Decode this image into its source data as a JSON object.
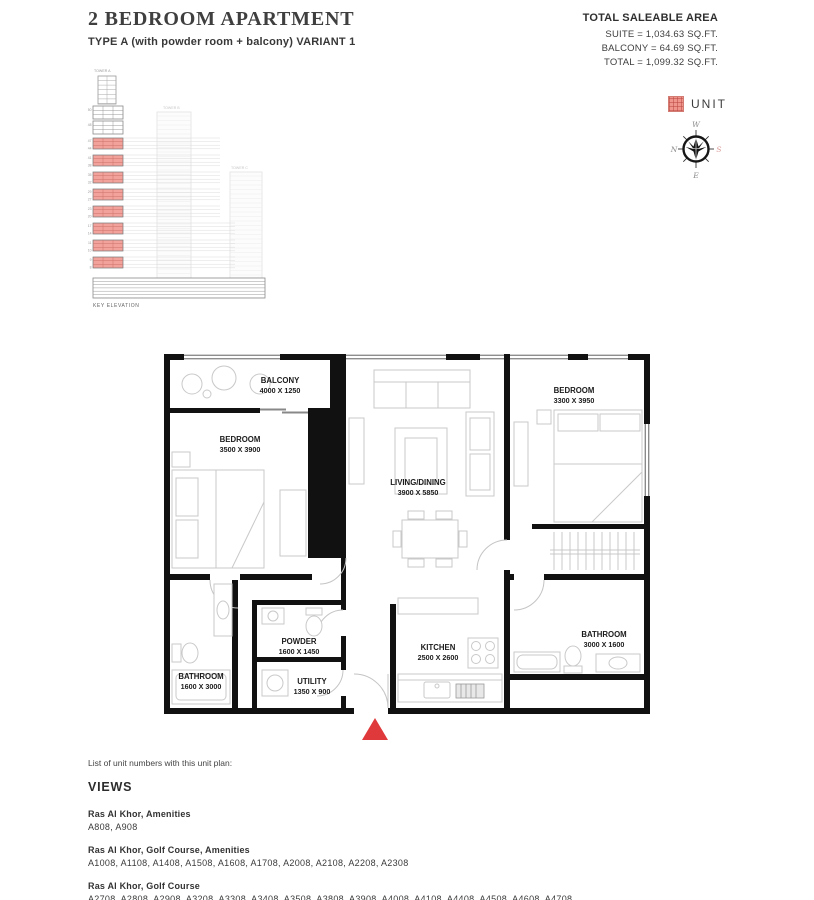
{
  "header": {
    "title": "2 BEDROOM APARTMENT",
    "subtitle": "TYPE A (with powder room + balcony) VARIANT 1"
  },
  "area_summary": {
    "heading": "TOTAL SALEABLE AREA",
    "suite": "SUITE = 1,034.63 SQ.FT.",
    "balcony": "BALCONY = 64.69 SQ.FT.",
    "total": "TOTAL = 1,099.32 SQ.FT."
  },
  "key_elevation": {
    "tower_a": "TOWER A",
    "tower_b": "TOWER B",
    "tower_c": "TOWER C",
    "caption": "KEY ELEVATION",
    "upper_ticks": [
      "50",
      "48"
    ],
    "bands": [
      {
        "top": "47",
        "bottom": "44"
      },
      {
        "top": "41",
        "bottom": "38"
      },
      {
        "top": "35",
        "bottom": "32"
      },
      {
        "top": "29",
        "bottom": "27"
      },
      {
        "top": "23",
        "bottom": "20"
      },
      {
        "top": "17",
        "bottom": "14"
      },
      {
        "top": "11",
        "bottom": "10"
      },
      {
        "top": "9",
        "bottom": "8"
      }
    ]
  },
  "legend": {
    "unit_label": "UNIT",
    "unit_color": "#f0958c"
  },
  "compass": {
    "n": "N",
    "e": "E",
    "s": "S",
    "w": "W"
  },
  "plan": {
    "rooms": [
      {
        "id": "balcony",
        "name": "BALCONY",
        "dims": "4000 X 1250"
      },
      {
        "id": "bedroom-1",
        "name": "BEDROOM",
        "dims": "3500 X 3900"
      },
      {
        "id": "living-dining",
        "name": "LIVING/DINING",
        "dims": "3900 X 5850"
      },
      {
        "id": "bedroom-2",
        "name": "BEDROOM",
        "dims": "3300 X 3950"
      },
      {
        "id": "bathroom-1",
        "name": "BATHROOM",
        "dims": "1600 X 3000"
      },
      {
        "id": "powder",
        "name": "POWDER",
        "dims": "1600 X 1450"
      },
      {
        "id": "utility",
        "name": "UTILITY",
        "dims": "1350 X 900"
      },
      {
        "id": "kitchen",
        "name": "KITCHEN",
        "dims": "2500 X 2600"
      },
      {
        "id": "bathroom-2",
        "name": "BATHROOM",
        "dims": "3000 X 1600"
      }
    ]
  },
  "colors": {
    "unit_fill": "#f2a29b",
    "unit_grid": "#cb736b",
    "entry_arrow": "#e0393c",
    "wall": "#111111"
  },
  "unit_list": {
    "intro": "List of unit numbers with this unit plan:",
    "heading": "VIEWS",
    "groups": [
      {
        "view": "Ras Al Khor, Amenities",
        "units": "A808, A908"
      },
      {
        "view": "Ras Al Khor, Golf Course, Amenities",
        "units": "A1008, A1108, A1408, A1508, A1608, A1708, A2008, A2108, A2208, A2308"
      },
      {
        "view": "Ras Al Khor, Golf Course",
        "units": "A2708, A2808, A2908, A3208, A3308, A3408, A3508, A3808, A3908, A4008, A4108, A4408, A4508, A4608, A4708"
      }
    ]
  }
}
